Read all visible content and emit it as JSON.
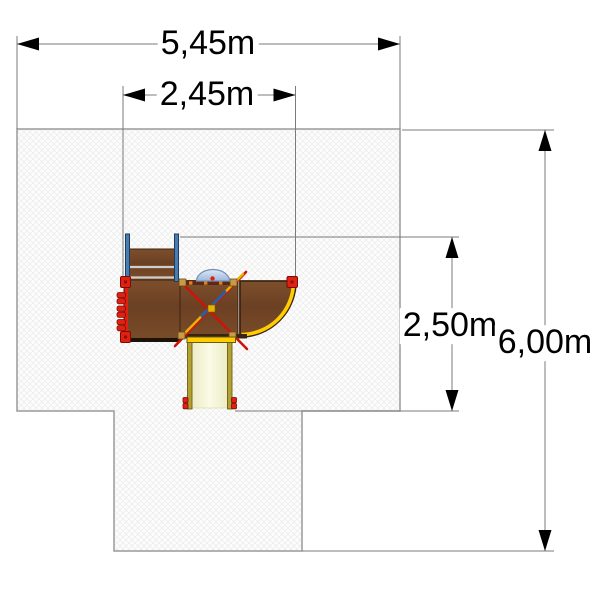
{
  "title": "Playground equipment top view with safety-zone dimensions",
  "dimensions": {
    "total_width": {
      "label": "5,45m"
    },
    "structure_width": {
      "label": "2,45m"
    },
    "structure_depth": {
      "label": "2,50m"
    },
    "total_depth": {
      "label": "6,00m"
    }
  },
  "colors": {
    "zone_fill": "#fcfcfc",
    "zone_border": "#9a9a9a",
    "dim_line": "#7b7b7b",
    "dim_text": "#000000",
    "arrow": "#000000",
    "wood": "#754a2a",
    "wood_edge": "#3d2410",
    "maroon_rail": "#5c2a14",
    "red": "#e02010",
    "red_dark": "#7a0c06",
    "yellow": "#ffcd00",
    "brace_red": "#cc1408",
    "brace_yellow": "#e6b400",
    "brace_blue": "#2a5f9e",
    "rail_blue": "#4a7cb0",
    "olive": "#b3a233",
    "cream": "#f6f6d9",
    "dome_blue": "#bacdea",
    "corner_tan": "#c89a4a"
  }
}
